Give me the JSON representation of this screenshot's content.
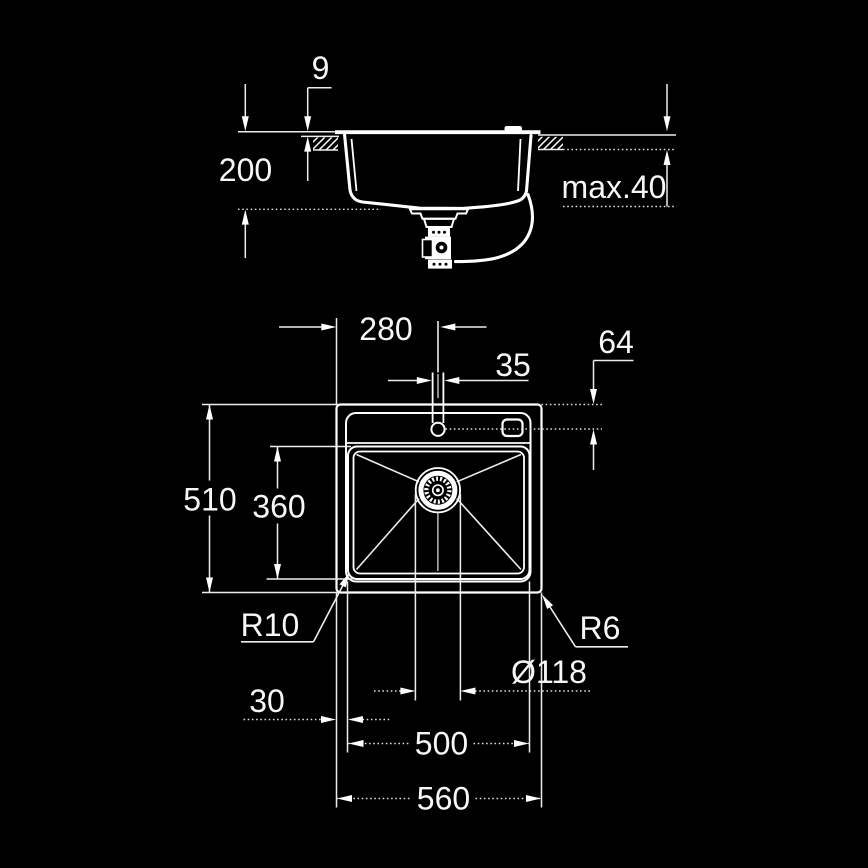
{
  "colors": {
    "background": "#000000",
    "line": "#ffffff"
  },
  "section_view": {
    "name": "sink side section view",
    "labels": {
      "rim_height": "9",
      "bowl_depth": "200",
      "max_counter_thickness": "max.40"
    }
  },
  "plan_view": {
    "name": "sink top plan view",
    "labels": {
      "faucet_offset_x": "280",
      "faucet_hole_diameter": "35",
      "faucet_offset_y": "64",
      "overall_depth": "510",
      "bowl_front_to_back": "360",
      "bowl_corner_radius": "R10",
      "outer_corner_radius": "R6",
      "drain_diameter": "Ø118",
      "edge_to_bowl": "30",
      "bowl_width": "500",
      "overall_width": "560"
    }
  }
}
